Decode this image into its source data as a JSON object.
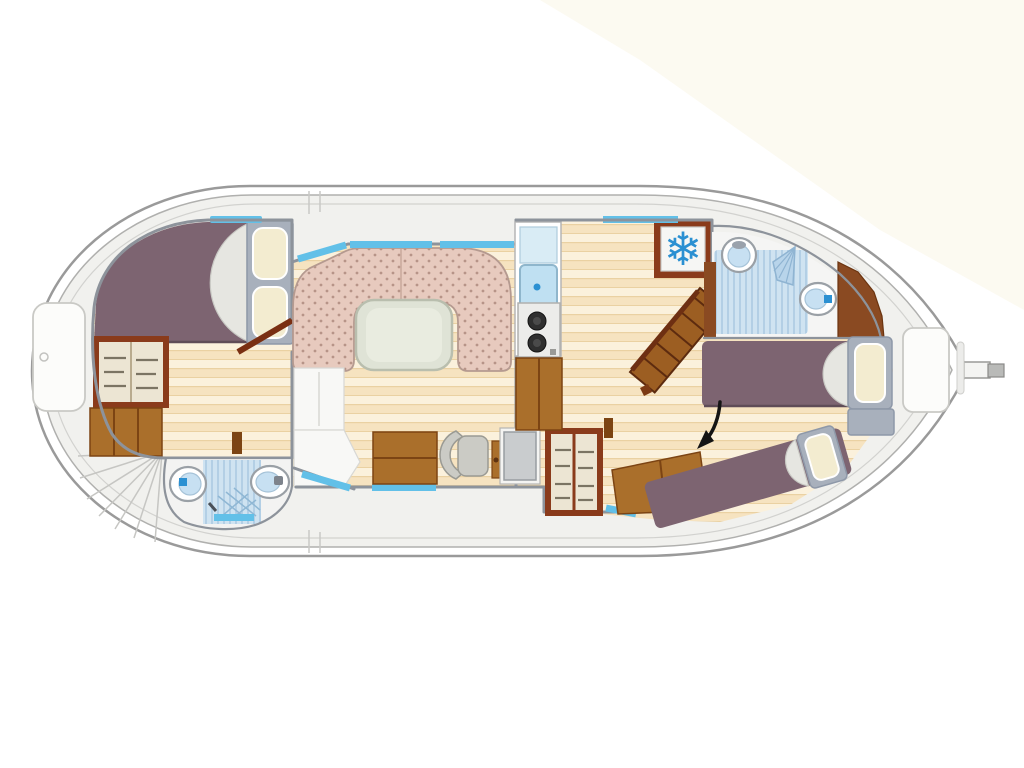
{
  "title": "Houseboat interior layout floor plan (top-down view)",
  "colors": {
    "cream": "#faf6e8",
    "hullFill": "#ffffff",
    "hullLine": "#9a9a9a",
    "hullLine2": "#b0b0ae",
    "hullLine3": "#d2d2cf",
    "deck": "#f1f1ee",
    "wall": "#8d939b",
    "purple": "#7d6471",
    "purpleDark": "#5f4c57",
    "blanket": "#e6e6e1",
    "blanketEdge": "#c8c8c3",
    "frameGray": "#a8b0bc",
    "frameGrayEdge": "#8e98a8",
    "pillow": "#f3ecd0",
    "win": "#62c0e8",
    "brown": "#aa6f2b",
    "brownDark": "#7c4413",
    "frame": "#8a3b1b",
    "shelfBg": "#ece5d3",
    "shelfLine": "#7b7463",
    "white": "#fcfcfa",
    "fixtureBlue": "#c7e0f2",
    "accentBlue": "#2b90d2",
    "shower": "#cfe3f1",
    "showerStripe": "#b3cfe5",
    "sofa": "#e7cabe",
    "sofaDot": "#b79488",
    "sofaEdge": "#b59a90",
    "table": "#dfe3d6",
    "tableEdge": "#b9beae",
    "tableInner": "#e9ece0",
    "grayBox": "#c9ccce",
    "chair": "#cbcbc5",
    "stairBrown": "#9c5e22",
    "stairEdge": "#5d2b0f",
    "stove": "#ececea",
    "burner": "#2f2f2f",
    "arrow": "#141414"
  },
  "rooms": [
    {
      "id": "cabin-left",
      "name": "Double berth cabin with wardrobe and chest"
    },
    {
      "id": "bathroom-left",
      "name": "Shower room with WC and washbasin"
    },
    {
      "id": "saloon",
      "name": "Saloon with U-shaped dinette sofa and table"
    },
    {
      "id": "galley",
      "name": "Galley with sink, two-burner hob and refrigerator"
    },
    {
      "id": "helm",
      "name": "Inside steering position with swivel chair and console"
    },
    {
      "id": "bathroom-right",
      "name": "Shower room with WC, washbasin and hand shower"
    },
    {
      "id": "cabin-right",
      "name": "Aft cabin with two single berths"
    }
  ],
  "fixtures": [
    "double-berth",
    "pillows",
    "wardrobe",
    "chest-of-drawers",
    "toilet",
    "washbasin",
    "shower-floor",
    "boarding-steps-fan",
    "u-sofa",
    "dinette-table",
    "sink",
    "drainboard",
    "two-burner-hob",
    "refrigerator-snowflake",
    "companionway-stairs",
    "swivel-chair",
    "helm-console",
    "shelf-cabinet",
    "single-berth",
    "deck-hatch",
    "rudder",
    "windows"
  ],
  "annotation": {
    "type": "arrow",
    "meaning": "points to aft single berth"
  }
}
